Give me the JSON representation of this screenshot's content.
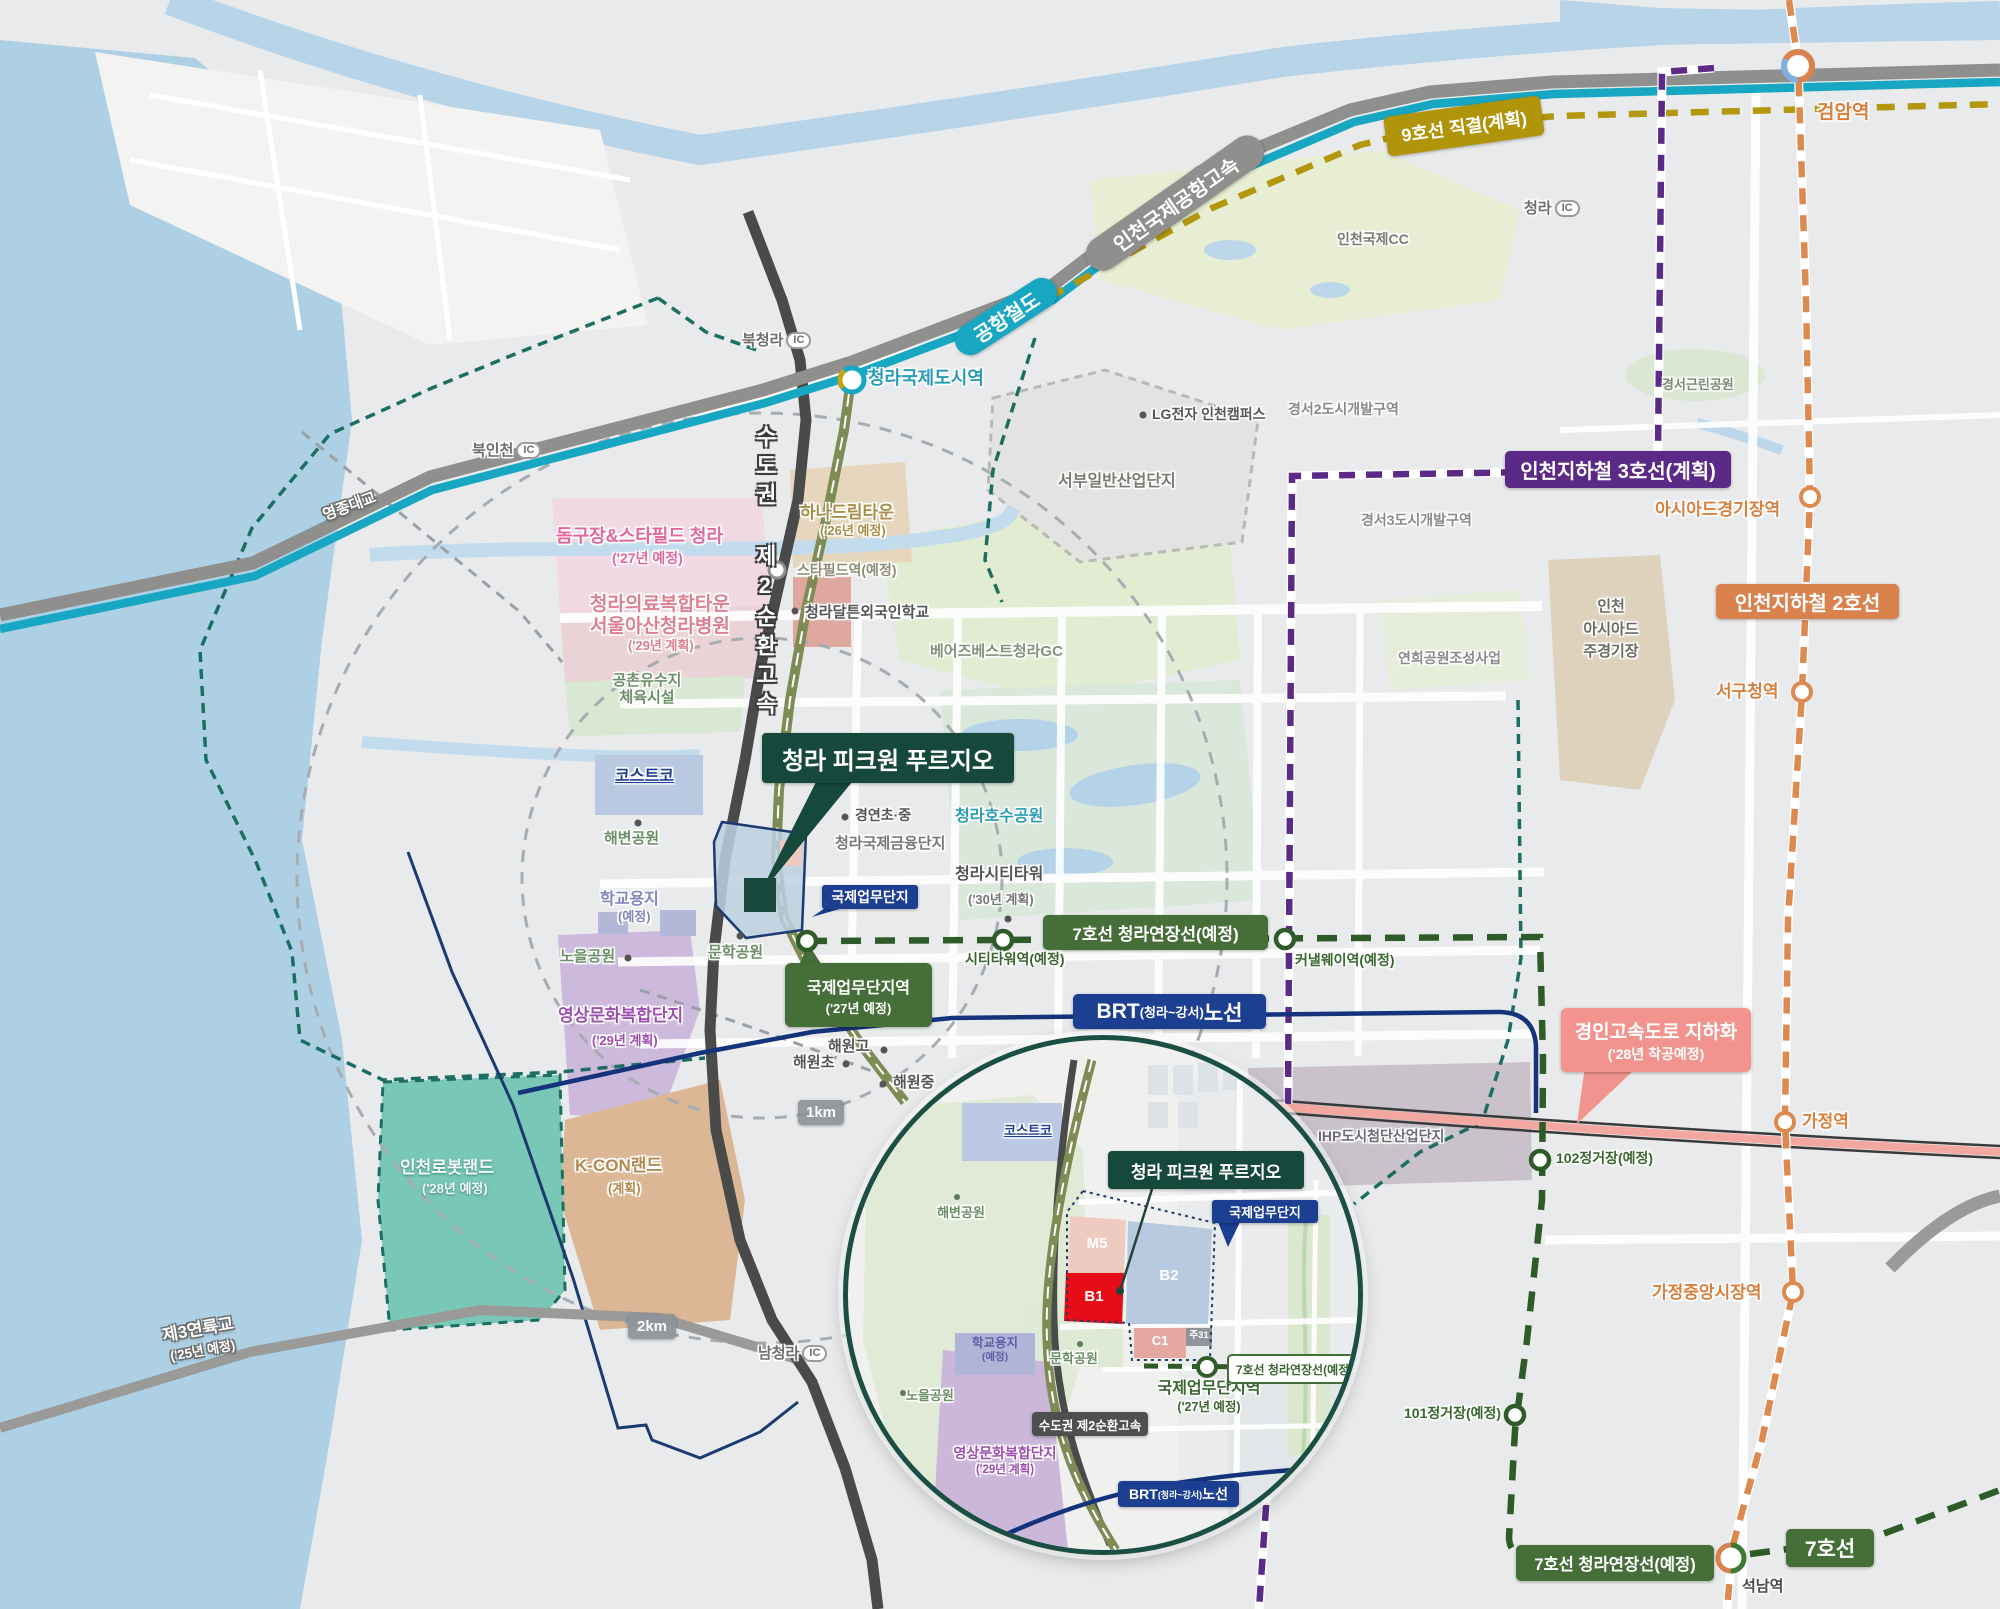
{
  "colors": {
    "accent_green": "#17483c",
    "line7_green": "#456e38",
    "navy": "#1c3f92",
    "purple3": "#5b2a86",
    "orange2": "#d9824e",
    "gold9": "#b0940a",
    "arex_teal": "#17a7c3",
    "pink_hwy": "#f2948d",
    "b1_red": "#e60d19"
  },
  "lines": {
    "line9": "9호선 직결(계획)",
    "arex": "공항철도",
    "subway3": "인천지하철 3호선(계획)",
    "subway2": "인천지하철 2호선",
    "line7_ext": "7호선 청라연장선(예정)",
    "line7": "7호선",
    "brt_prefix": "BRT",
    "brt_mid": "(청라~강서)",
    "brt_suffix": "노선",
    "gyeongin_title": "경인고속도로 지하화",
    "gyeongin_note": "('28년 착공예정)"
  },
  "roads": {
    "airport_expwy": "인천국제공항고속",
    "ring2": "수도권 제2순환고속",
    "yeongjong": "영종대교",
    "bridge3": "제3연륙교",
    "bridge3_note": "('25년 예정)",
    "ic": "IC",
    "ic_bukcheongna": "북청라",
    "ic_bukincheon": "북인천",
    "ic_namcheongna": "남청라",
    "ic_cheongna": "청라"
  },
  "stations": {
    "geomam": "검암역",
    "cheongna_intl": "청라국제도시역",
    "starfield": "스타필드역(예정)",
    "asiad": "아시아드경기장역",
    "seogucheong": "서구청역",
    "gajeong": "가정역",
    "gajeong_market": "가정중앙시장역",
    "seoknam": "석남역",
    "citytower": "시티타워역(예정)",
    "canalway": "커낼웨이역(예정)",
    "intl_biz": "국제업무단지역",
    "intl_biz_note": "('27년 예정)",
    "stop102": "102정거장(예정)",
    "stop101": "101정거장(예정)"
  },
  "project": {
    "name": "청라 피크원 푸르지오",
    "district": "국제업무단지"
  },
  "places": {
    "hana": "하나드림타운",
    "hana_note": "('26년 예정)",
    "dalton": "청라달튼외국인학교",
    "bears": "베어즈베스트청라GC",
    "dome": "돔구장&스타필드 청라",
    "dome_note": "('27년 예정)",
    "medical1": "청라의료복합타운",
    "medical2": "서울아산청라병원",
    "medical_note": "('29년 계획)",
    "gongchon": "공촌유수지\n체육시설",
    "costco": "코스트코",
    "beach_park": "해변공원",
    "school_site": "학교용지",
    "school_site_note": "(예정)",
    "noeul": "노을공원",
    "munhak": "문학공원",
    "gyeongyeon": "경연초·중",
    "finance": "청라국제금융단지",
    "lake_park": "청라호수공원",
    "citytower_bldg": "청라시티타워",
    "citytower_note": "('30년 계획)",
    "haewon_go": "해원고",
    "haewon_cho": "해원초",
    "haewon_jung": "해원중",
    "media_city": "영상문화복합단지",
    "media_city_note": "('29년 계획)",
    "kcon": "K-CON랜드",
    "kcon_note": "(계획)",
    "robotland": "인천로봇랜드",
    "robotland_note": "('28년 예정)",
    "ihp": "IHP도시첨단산업단지",
    "lg": "LG전자 인천캠퍼스",
    "seobu": "서부일반산업단지",
    "gyeongseo2": "경서2도시개발구역",
    "gyeongseo3": "경서3도시개발구역",
    "gyeongseo_park": "경서근린공원",
    "yeonhui": "연희공원조성사업",
    "incheon_cc": "인천국제CC",
    "asiad_stadium": "인천\n아시아드\n주경기장"
  },
  "badges": {
    "km1": "1km",
    "km2": "2km"
  },
  "inset_blocks": {
    "m5": "M5",
    "b1": "B1",
    "b2": "B2",
    "c1": "C1",
    "ju31": "주31"
  }
}
